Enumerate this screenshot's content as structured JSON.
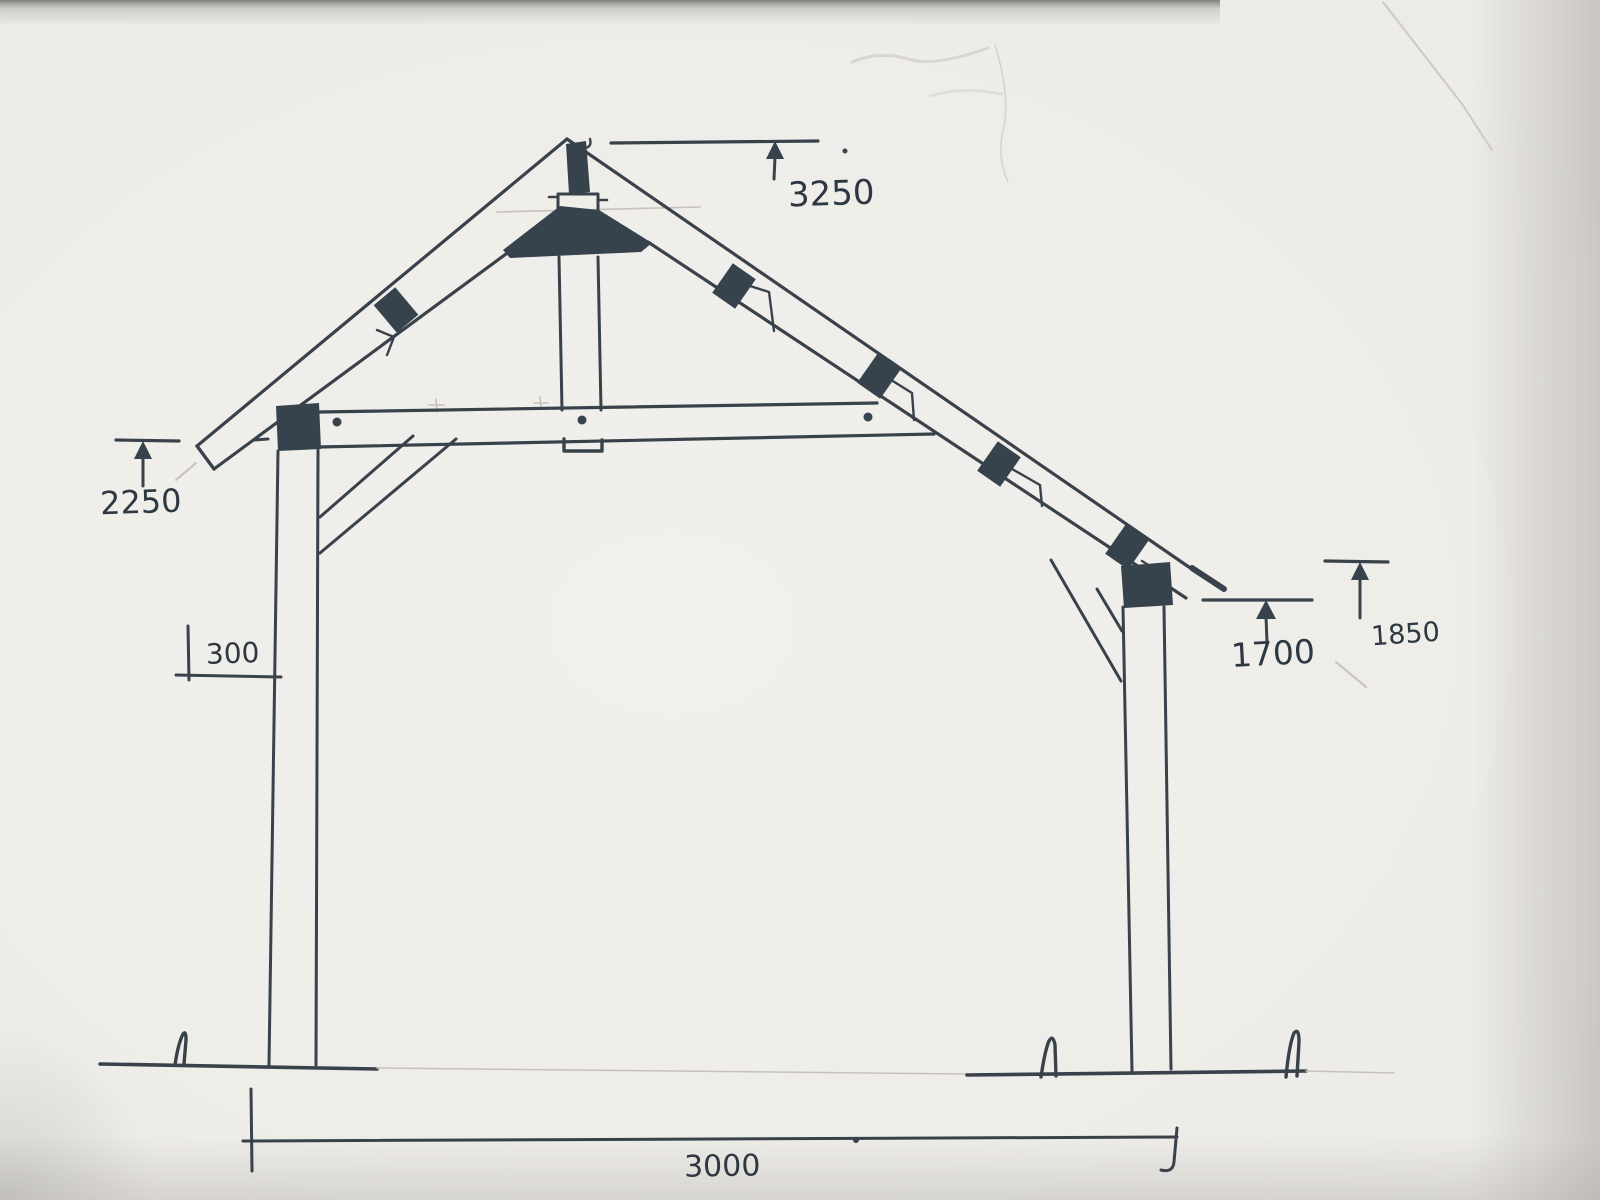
{
  "labels": {
    "ridge_height": "3250",
    "left_wall_height": "2250",
    "left_overhang": "300",
    "right_post_height": "1700",
    "right_wall_height": "1850",
    "span": "3000"
  },
  "colors": {
    "paper": "#edebe6",
    "ink": "#39424b",
    "ink_fill": "#36424c",
    "pencil": "#c6c2bb",
    "text": "#2d3842"
  }
}
